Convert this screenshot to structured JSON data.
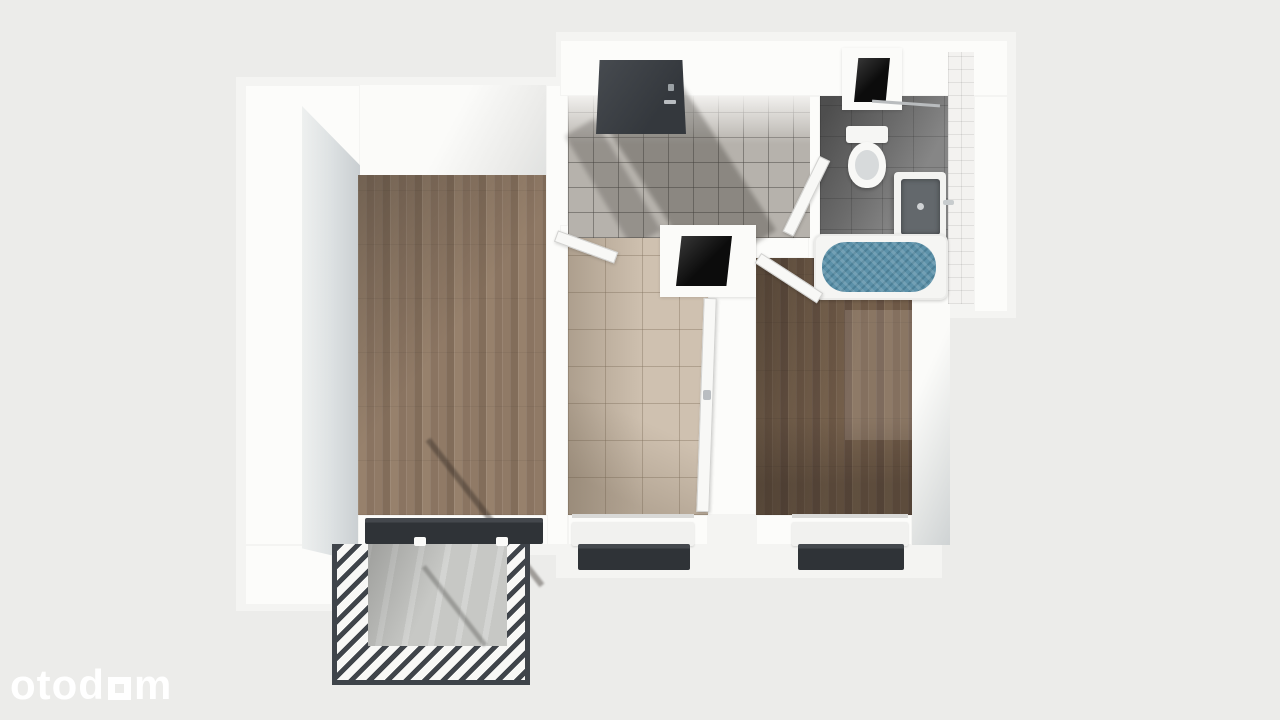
{
  "watermark": {
    "prefix": "otod",
    "suffix": "m",
    "square_glyph": "square-o-icon",
    "color": "#ffffff"
  },
  "palette": {
    "background": "#ececea",
    "wall": "#fcfcfa",
    "wall_shade": "#c9ced1",
    "wood_living": "#8d7663",
    "wood_bedroom": "#6d5846",
    "tile_kitchen": "#cfc1b0",
    "tile_hall": "#b6b2ac",
    "tile_bath_floor": "#868686",
    "tile_bath_wall": "#f3f2f0",
    "bathtub_water": "#5c91a9",
    "radiator": "#2f3337",
    "entry_door": "#34383d",
    "railing": "#3f444a",
    "balcony_concrete": "#c7c8c5",
    "shaft": "#0c0c0c"
  },
  "rooms": [
    {
      "id": "living-room",
      "floor": "light-wood-planks"
    },
    {
      "id": "entry-hall",
      "floor": "gray-tiles"
    },
    {
      "id": "kitchen",
      "floor": "beige-tiles"
    },
    {
      "id": "bedroom",
      "floor": "dark-wood-planks"
    },
    {
      "id": "bathroom",
      "floor": "dark-gray-tiles"
    },
    {
      "id": "balcony",
      "floor": "concrete"
    }
  ],
  "fixtures": [
    "entry-door",
    "bathroom-door",
    "bedroom-door",
    "kitchen-door",
    "toilet",
    "washbasin",
    "bathtub",
    "towel-rail",
    "ventilation-shaft-bathroom",
    "ventilation-shaft-hall",
    "radiator-living-room",
    "radiator-kitchen",
    "radiator-bedroom",
    "window-kitchen",
    "window-bedroom",
    "balcony-railing"
  ]
}
